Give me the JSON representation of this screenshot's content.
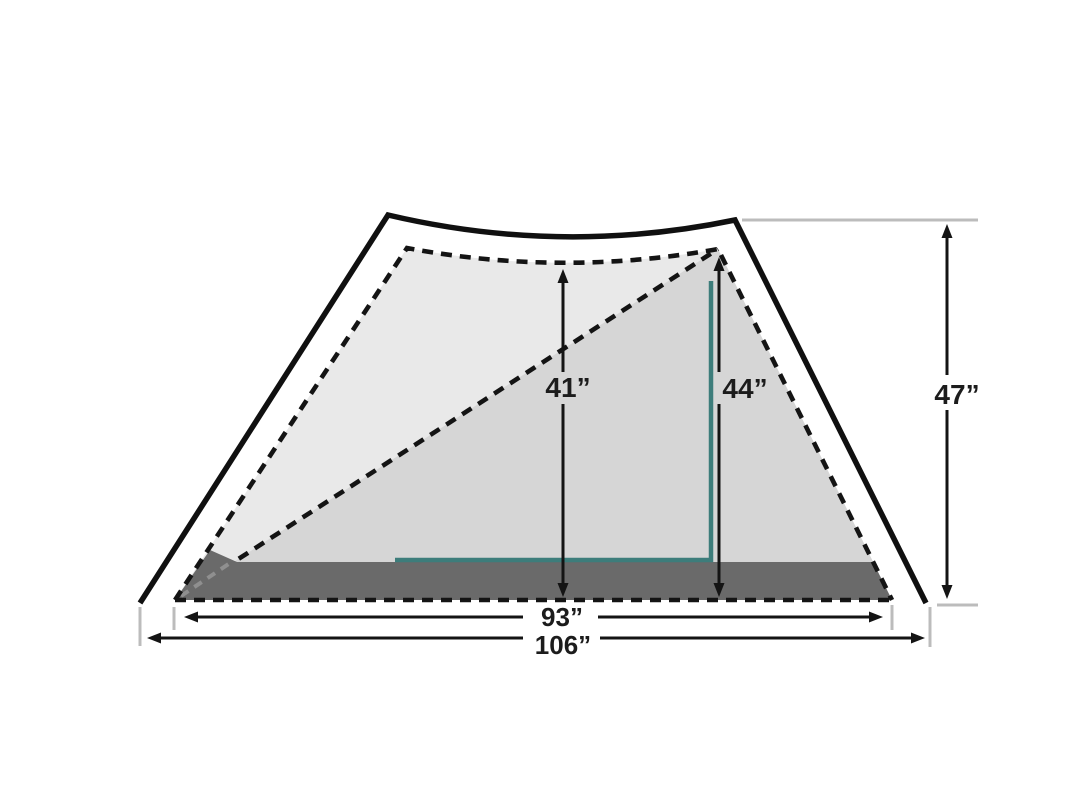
{
  "diagram": {
    "type": "tent-dimension-diagram",
    "dimensions": {
      "interior_height_mid": "41”",
      "interior_height_peak": "44”",
      "exterior_height_peak": "47”",
      "interior_length": "93”",
      "exterior_length": "106”"
    },
    "colors": {
      "background": "#ffffff",
      "outline_black": "#101010",
      "inner_fill_light": "#e9e9e9",
      "inner_fill_shaded": "#d6d6d6",
      "floor_fill": "#6a6a6a",
      "accent_teal": "#3d7d7b",
      "reference_gray": "#bcbcbc",
      "label_text": "#1c1c1c"
    }
  }
}
